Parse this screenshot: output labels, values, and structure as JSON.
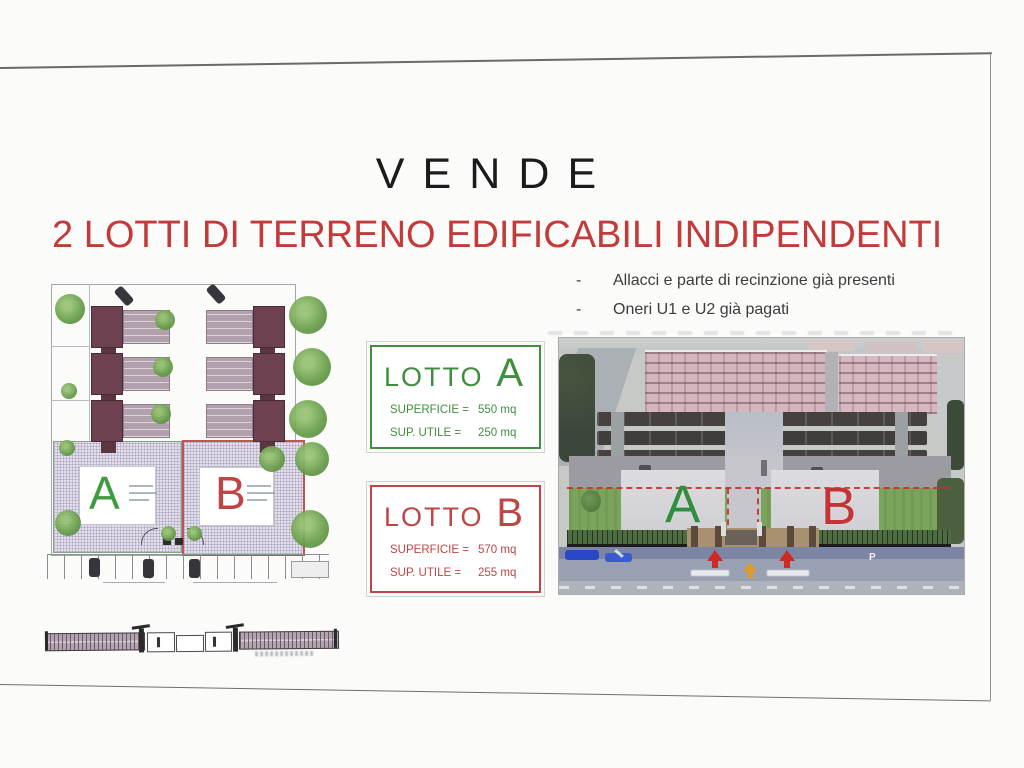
{
  "page": {
    "title": "VENDE",
    "heading": "2 LOTTI DI TERRENO EDIFICABILI INDIPENDENTI",
    "bullets": [
      {
        "marker": "-",
        "text": "Allacci e parte di recinzione già presenti"
      },
      {
        "marker": "-",
        "text": "Oneri U1 e U2 già pagati"
      }
    ]
  },
  "lot_boxes": [
    {
      "title": "LOTTO",
      "letter": "A",
      "accent_color": "#3f8f3f",
      "rows": [
        {
          "label": "SUPERFICIE =",
          "value": "550 mq"
        },
        {
          "label": "SUP. UTILE =",
          "value": "250 mq"
        }
      ]
    },
    {
      "title": "LOTTO",
      "letter": "B",
      "accent_color": "#c04545",
      "rows": [
        {
          "label": "SUPERFICIE =",
          "value": "570 mq"
        },
        {
          "label": "SUP. UTILE =",
          "value": "255 mq"
        }
      ]
    }
  ],
  "site_plan": {
    "lot_a_letter": "A",
    "lot_b_letter": "B",
    "lot_a_color": "#3f9b3f",
    "lot_b_color": "#c24343"
  },
  "aerial_photo": {
    "lot_a_letter": "A",
    "lot_b_letter": "B",
    "parking_letter": "P",
    "lot_a_color": "#2f8f3f",
    "lot_b_color": "#c53434"
  }
}
